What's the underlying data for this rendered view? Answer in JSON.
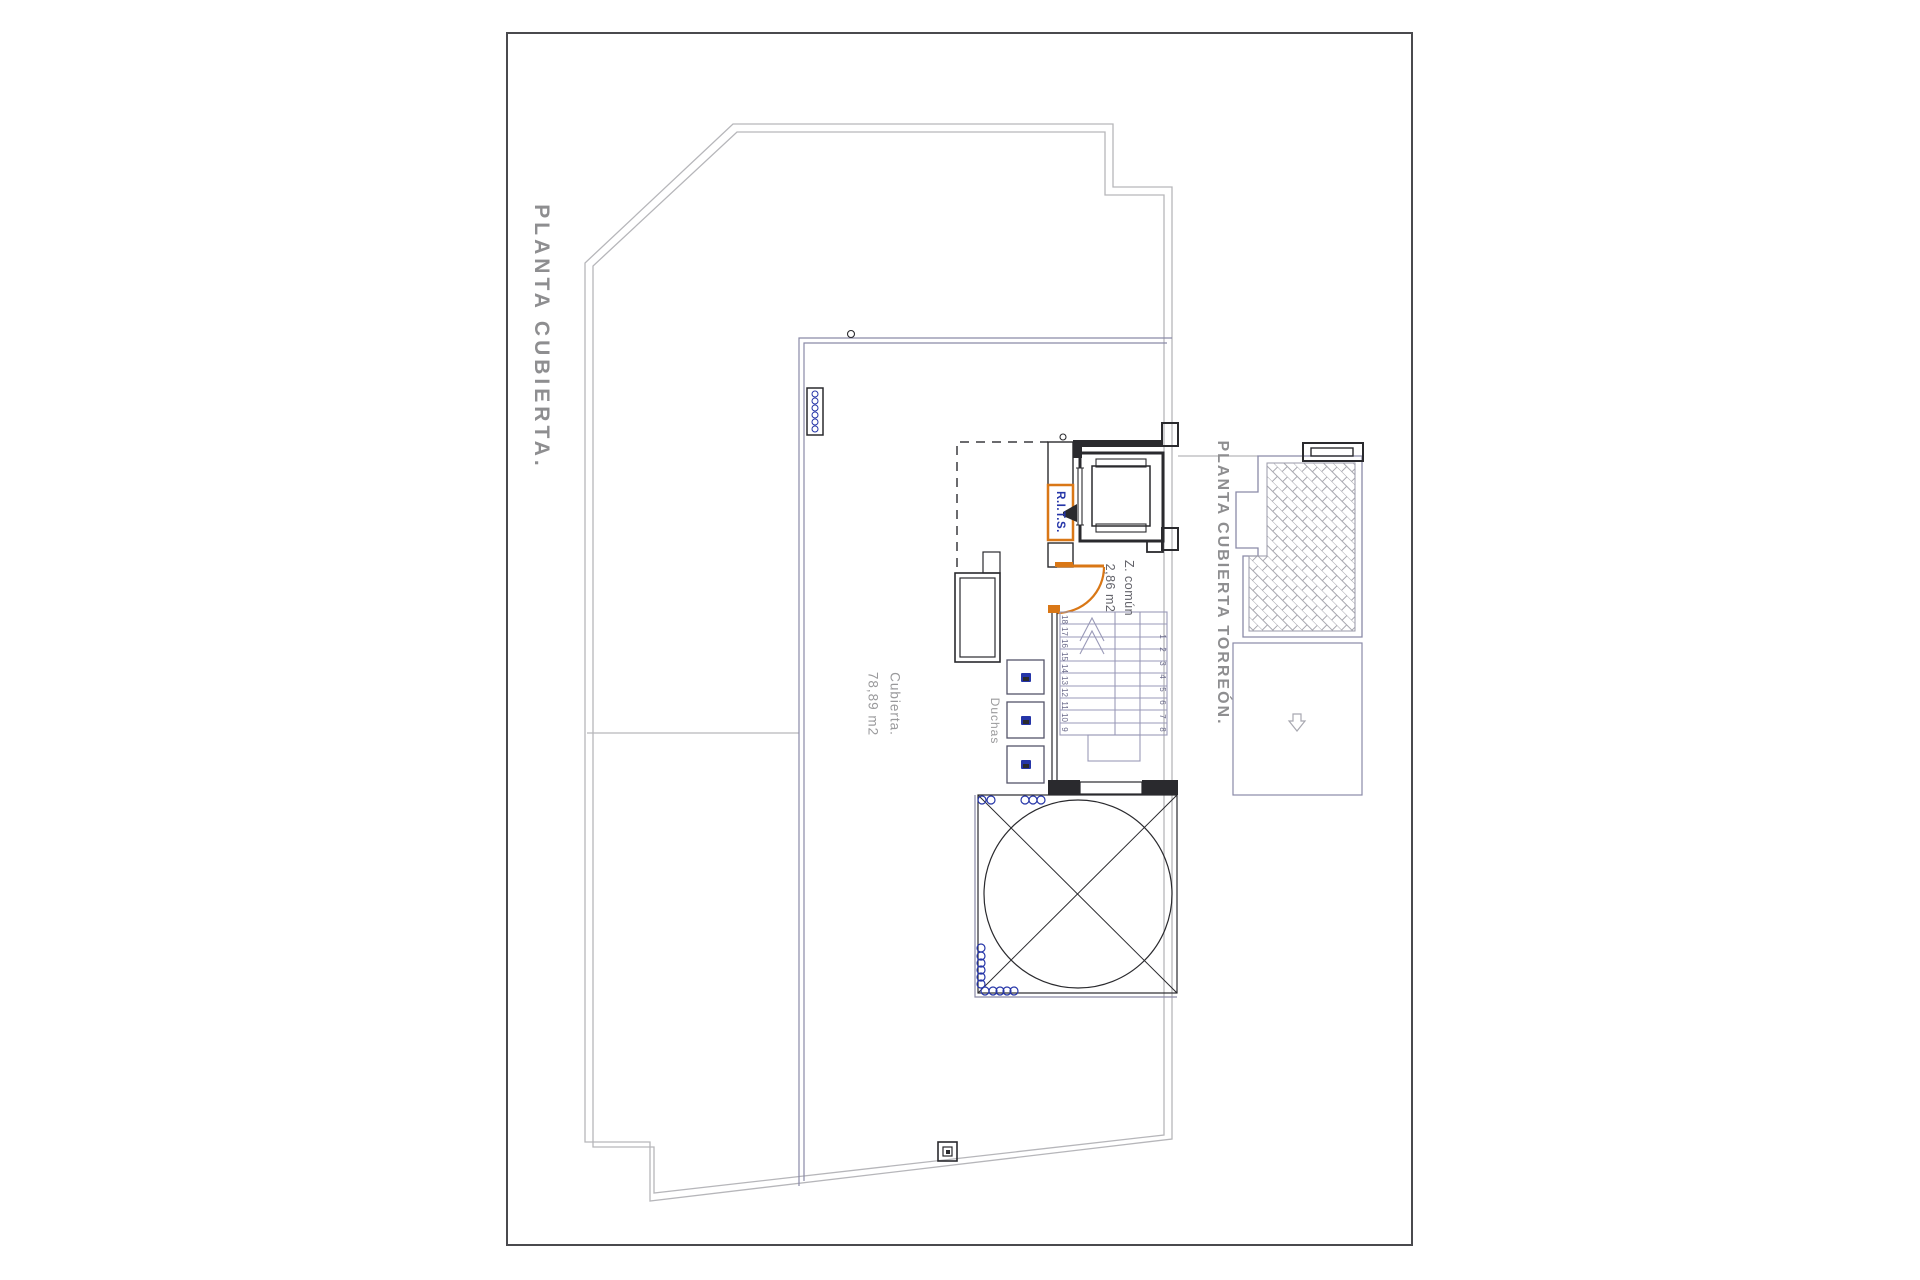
{
  "sheet": {
    "side_title": "PLANTA CUBIERTA.",
    "torreon_title": "PLANTA CUBIERTA TORREÓN."
  },
  "labels": {
    "roof_area": {
      "line1": "Cubierta.",
      "line2": "78,89 m2"
    },
    "common_zone": {
      "line1": "Z. común",
      "line2": "2,86 m2"
    },
    "showers": "Duchas",
    "telecom_riser": "R.I.T.S."
  },
  "stairs": {
    "left_flight_numbers": [
      "18",
      "17",
      "16",
      "15",
      "14",
      "13",
      "12",
      "11",
      "10",
      "9"
    ],
    "right_flight_numbers": [
      "1",
      "2",
      "3",
      "4",
      "5",
      "6",
      "7",
      "8"
    ]
  },
  "colors": {
    "accent_orange": "#d97716",
    "annotation_blue": "#2535a8",
    "title_gray": "#8e8e90",
    "label_gray": "#9a9a9c",
    "zone_gray": "#63636a",
    "outline_gray": "#b6b6ba",
    "plan_blue_gray": "#8a8aa8",
    "stair_blue": "#9a9ab8",
    "stair_num": "#6a6a8a",
    "hatch_gray": "#a8a8b0",
    "stripe_gray": "#b9b9bd",
    "wall_dark": "#2a2a2e",
    "sheet_border": "#4a4a4e"
  }
}
